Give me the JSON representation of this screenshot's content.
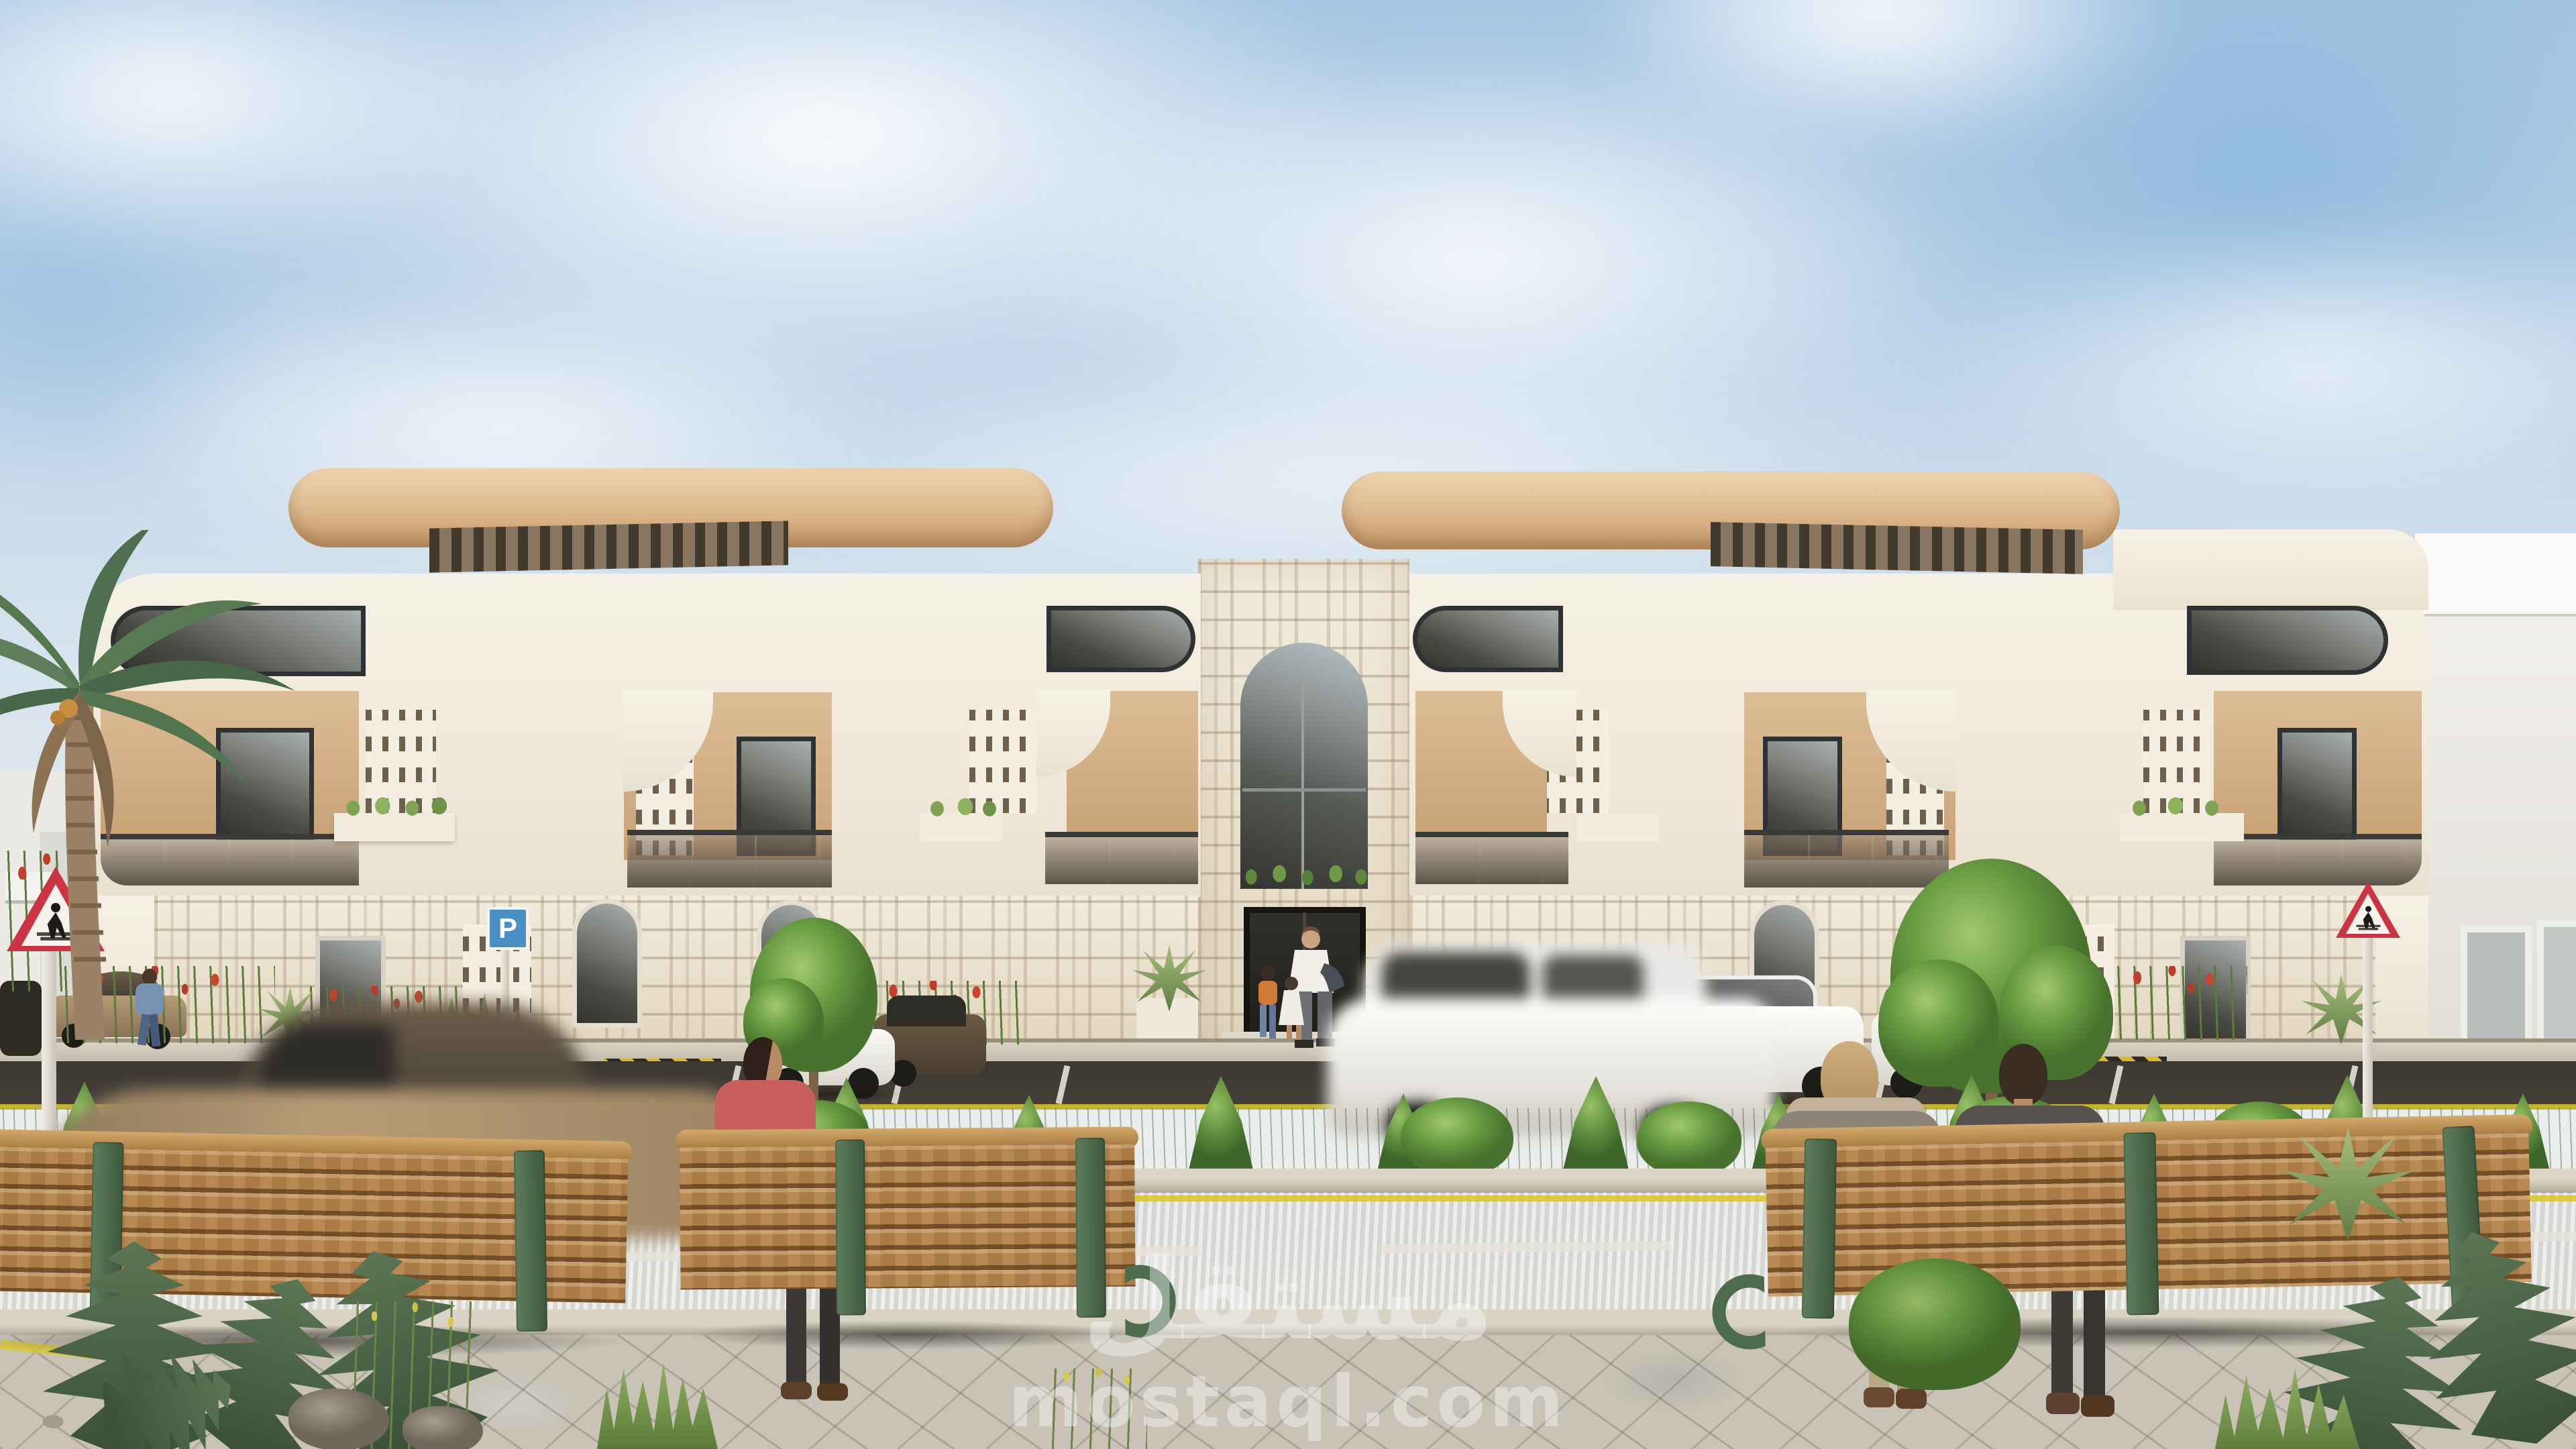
{
  "watermark": {
    "logo_arabic": "مستقل",
    "site": "mostaql.com"
  },
  "signs": {
    "parking": {
      "label": "P",
      "count": 2
    },
    "pedestrian_crossing": {
      "count": 2
    }
  },
  "scene": {
    "villas": 2,
    "central_stone_entrance": 1,
    "benches": 3,
    "palm_trees": 1,
    "street_trees": 2,
    "fire_hydrants": 2,
    "parked_cars": 6,
    "moving_blurred_cars": 2,
    "people": {
      "at_entrance": 3,
      "walking": 1,
      "standing_behind_bench": 1,
      "seated_on_bench": 2
    }
  },
  "colors": {
    "skyTop": "#a3c4e2",
    "skyDeep": "#8fb9dd",
    "skyLow": "#e9edee",
    "cream": "#f0e9da",
    "stone": "#ece3d1",
    "canopy": "#e0bd93",
    "canopyDeep": "#c89c6c",
    "tanWall": "#c9a277",
    "tanLight": "#dcbd96",
    "glassDark": "#34342e",
    "road": "#5c554b",
    "parking": "#45403a",
    "laneYellow": "#d9c832",
    "laneWhite": "#e6e3d9",
    "grass": "#7aa24f",
    "wood": "#b5834a",
    "ironGreen": "#4d6b4d",
    "sidewalk": "#c8c2b7",
    "curb": "#cfc7b5",
    "hydrant": "#c14b38",
    "signBlue": "#4a90c4",
    "signRed": "#cc3344"
  }
}
